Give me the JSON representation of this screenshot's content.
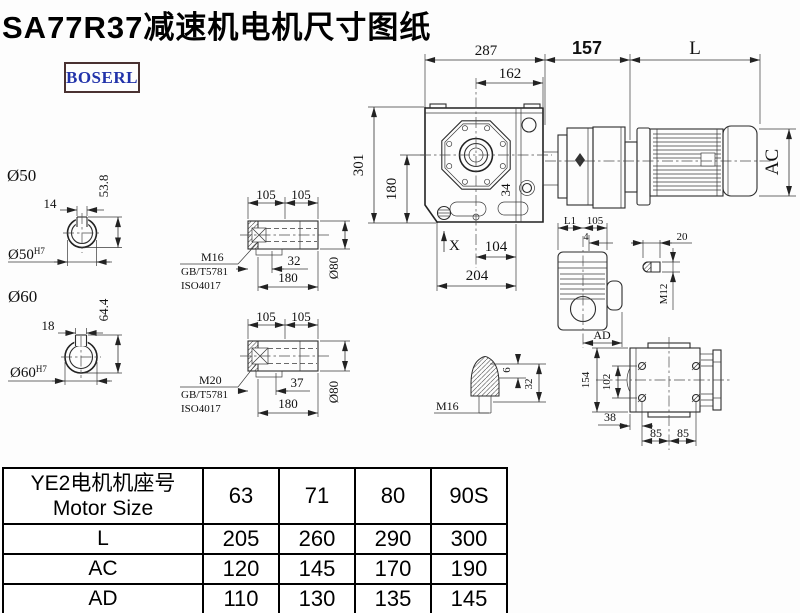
{
  "title": "SA77R37减速机电机尺寸图纸",
  "logo": "BOSERL",
  "main_view": {
    "d287": "287",
    "d162": "162",
    "d157": "157",
    "dL": "L",
    "d301": "301",
    "d180": "180",
    "d34": "34",
    "dX": "X",
    "d104": "104",
    "d204": "204",
    "dAC": "AC"
  },
  "shaft50": {
    "label": "Ø50",
    "key": "14",
    "height": "53.8",
    "bore": "Ø50",
    "bore_sup": "H7"
  },
  "shaft60": {
    "label": "Ø60",
    "key": "18",
    "height": "64.4",
    "bore": "Ø60",
    "bore_sup": "H7"
  },
  "hollow1": {
    "t1": "105",
    "t2": "105",
    "bolt": "M16",
    "std1": "GB/T5781",
    "std2": "ISO4017",
    "depth": "32",
    "len": "180",
    "dia": "Ø80"
  },
  "hollow2": {
    "t1": "105",
    "t2": "105",
    "bolt": "M20",
    "std1": "GB/T5781",
    "std2": "ISO4017",
    "depth": "37",
    "len": "180",
    "dia": "Ø80"
  },
  "sideview": {
    "dL1": "L1",
    "d105": "105",
    "d4": "4",
    "dAD": "AD"
  },
  "key_detail": {
    "d20": "20",
    "dM12": "M12"
  },
  "plug_detail": {
    "dM16": "M16",
    "d6": "6",
    "d32": "32"
  },
  "flange_view": {
    "d154": "154",
    "d102": "102",
    "d38": "38",
    "d85a": "85",
    "d85b": "85"
  },
  "table": {
    "header_cn": "YE2电机机座号",
    "header_en": "Motor Size",
    "sizes": [
      "63",
      "71",
      "80",
      "90S"
    ],
    "rows": [
      {
        "label": "L",
        "values": [
          "205",
          "260",
          "290",
          "300"
        ]
      },
      {
        "label": "AC",
        "values": [
          "120",
          "145",
          "170",
          "190"
        ]
      },
      {
        "label": "AD",
        "values": [
          "110",
          "130",
          "135",
          "145"
        ]
      }
    ]
  }
}
